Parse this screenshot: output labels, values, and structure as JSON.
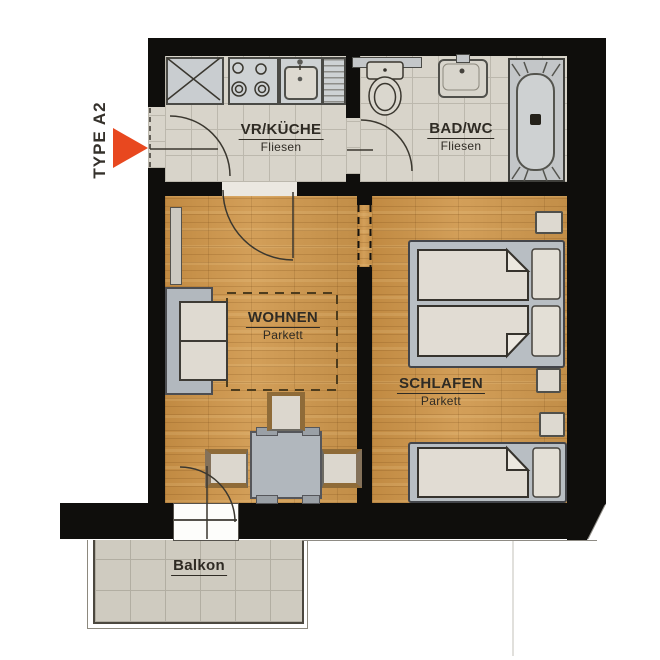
{
  "title": "TYPE A2",
  "rooms": [
    {
      "id": "vr-kueche",
      "name": "VR/KÜCHE",
      "floor": "Fliesen"
    },
    {
      "id": "bad-wc",
      "name": "BAD/WC",
      "floor": "Fliesen"
    },
    {
      "id": "wohnen",
      "name": "WOHNEN",
      "floor": "Parkett"
    },
    {
      "id": "schlafen",
      "name": "SCHLAFEN",
      "floor": "Parkett"
    },
    {
      "id": "balkon",
      "name": "Balkon",
      "floor": ""
    }
  ],
  "fixtures": {
    "kitchen": [
      "tall-cabinet-x",
      "stove-4-burners",
      "sink",
      "drainer"
    ],
    "bathroom": [
      "shelf",
      "toilet",
      "washbasin",
      "bathtub"
    ],
    "living": [
      "radiator",
      "sofa-2-seat",
      "furniture-zone-dashed",
      "dining-table",
      "chair-top",
      "chair-left",
      "chair-right",
      "balcony-door"
    ],
    "bedroom": [
      "double-bed",
      "single-bed",
      "nightstand",
      "nightstand",
      "nightstand"
    ]
  },
  "colors": {
    "wall": "#0f0e0c",
    "wood_floor": "#c79349",
    "tile_floor": "#d8d4ca",
    "balcony_tile": "#cfcbc0",
    "furniture_gray": "#b4bac0",
    "cushion": "#e0dbd2",
    "chair_wood": "#8f6b38",
    "arrow_red": "#e8481f",
    "label_text": "#2f2b24"
  }
}
